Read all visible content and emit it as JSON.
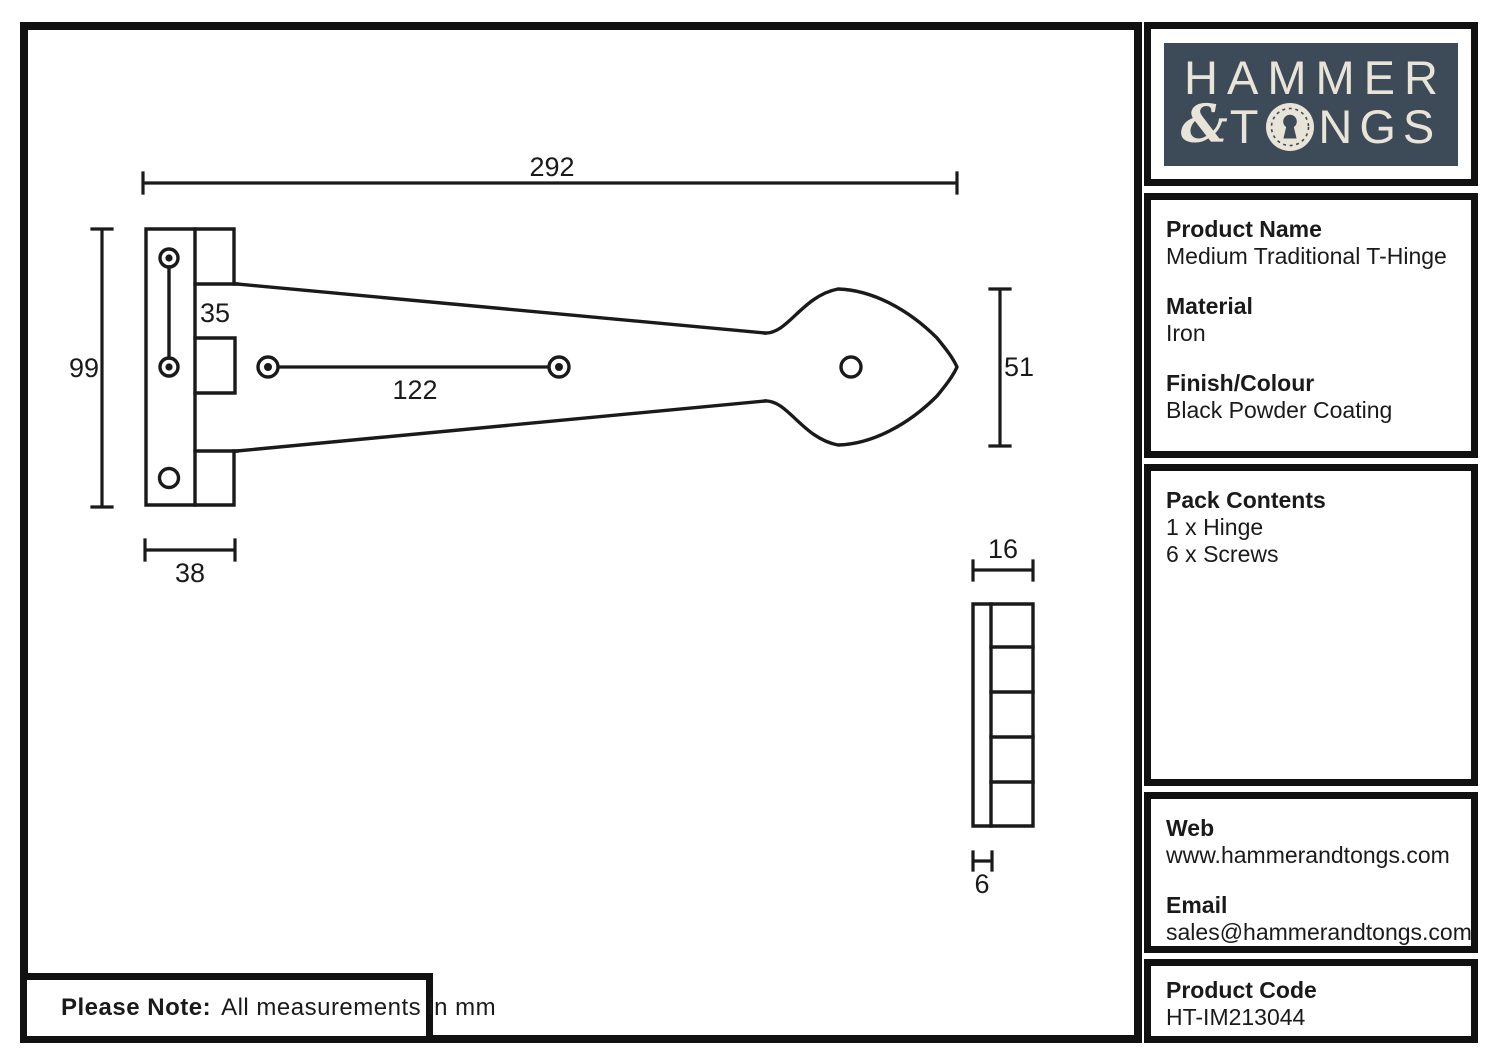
{
  "colors": {
    "navy": "#3d4a58",
    "cream": "#e9e4d8",
    "line": "#1a1a1a"
  },
  "logo": {
    "word1": "HAMMER",
    "ampersand": "&",
    "word2_prefix": "T",
    "word2_suffix": "NGS",
    "keyhole_icon": "keyhole-in-circle"
  },
  "sidebar": {
    "product": {
      "heading": "Product Name",
      "value": "Medium Traditional T-Hinge"
    },
    "material": {
      "heading": "Material",
      "value": "Iron"
    },
    "finish": {
      "heading": "Finish/Colour",
      "value": "Black Powder Coating"
    },
    "pack": {
      "heading": "Pack Contents",
      "items": [
        "1 x Hinge",
        "6 x Screws"
      ]
    },
    "web": {
      "heading": "Web",
      "value": "www.hammerandtongs.com"
    },
    "email": {
      "heading": "Email",
      "value": "sales@hammerandtongs.com"
    },
    "code": {
      "heading": "Product Code",
      "value": "HT-IM213044"
    }
  },
  "note": {
    "label": "Please Note:",
    "text": "All measurements in mm"
  },
  "drawing": {
    "units": "mm",
    "dimensions": {
      "overall_length": "292",
      "plate_height": "99",
      "strap_root_width": "35",
      "strap_hole_spacing": "122",
      "plate_width": "38",
      "head_width": "51",
      "side_view_width": "16",
      "thickness": "6"
    }
  }
}
